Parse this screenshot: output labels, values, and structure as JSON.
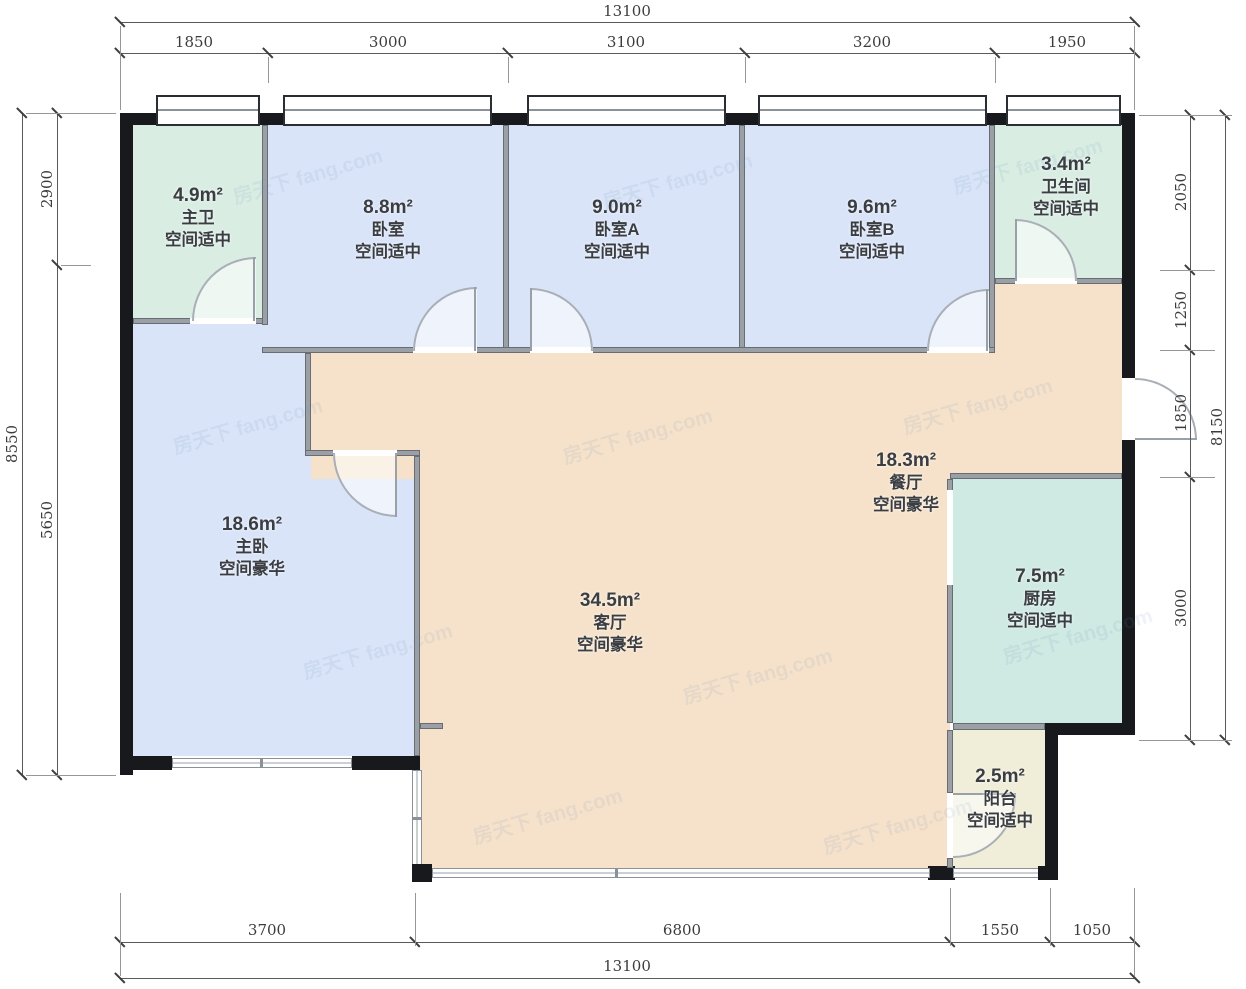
{
  "plan": {
    "rooms": [
      {
        "id": "master-bath",
        "area": "4.9m²",
        "name": "主卫",
        "quality": "空间适中"
      },
      {
        "id": "bedroom",
        "area": "8.8m²",
        "name": "卧室",
        "quality": "空间适中"
      },
      {
        "id": "bedroom-a",
        "area": "9.0m²",
        "name": "卧室A",
        "quality": "空间适中"
      },
      {
        "id": "bedroom-b",
        "area": "9.6m²",
        "name": "卧室B",
        "quality": "空间适中"
      },
      {
        "id": "bathroom",
        "area": "3.4m²",
        "name": "卫生间",
        "quality": "空间适中"
      },
      {
        "id": "master-bedroom",
        "area": "18.6m²",
        "name": "主卧",
        "quality": "空间豪华"
      },
      {
        "id": "living-room",
        "area": "34.5m²",
        "name": "客厅",
        "quality": "空间豪华"
      },
      {
        "id": "dining-room",
        "area": "18.3m²",
        "name": "餐厅",
        "quality": "空间豪华"
      },
      {
        "id": "kitchen",
        "area": "7.5m²",
        "name": "厨房",
        "quality": "空间适中"
      },
      {
        "id": "balcony",
        "area": "2.5m²",
        "name": "阳台",
        "quality": "空间适中"
      }
    ],
    "dimensions": {
      "top": {
        "total": "13100",
        "segments": [
          "1850",
          "3000",
          "3100",
          "3200",
          "1950"
        ]
      },
      "bottom": {
        "total": "13100",
        "segments": [
          "3700",
          "6800",
          "1550",
          "1050"
        ]
      },
      "left": {
        "total": "8550",
        "segments": [
          "2900",
          "5650"
        ]
      },
      "right": {
        "total": "8150",
        "segments": [
          "2050",
          "1250",
          "1850",
          "3000"
        ]
      }
    },
    "watermark": "房天下 fang.com",
    "colors": {
      "bedroom": "#d9e4f8",
      "bathroom": "#d9ede3",
      "kitchen": "#cfe9e3",
      "living": "#f6e2ca",
      "balcony": "#f0eed9",
      "exterior_wall": "#17191d",
      "interior_wall": "#9ba0a6"
    }
  }
}
